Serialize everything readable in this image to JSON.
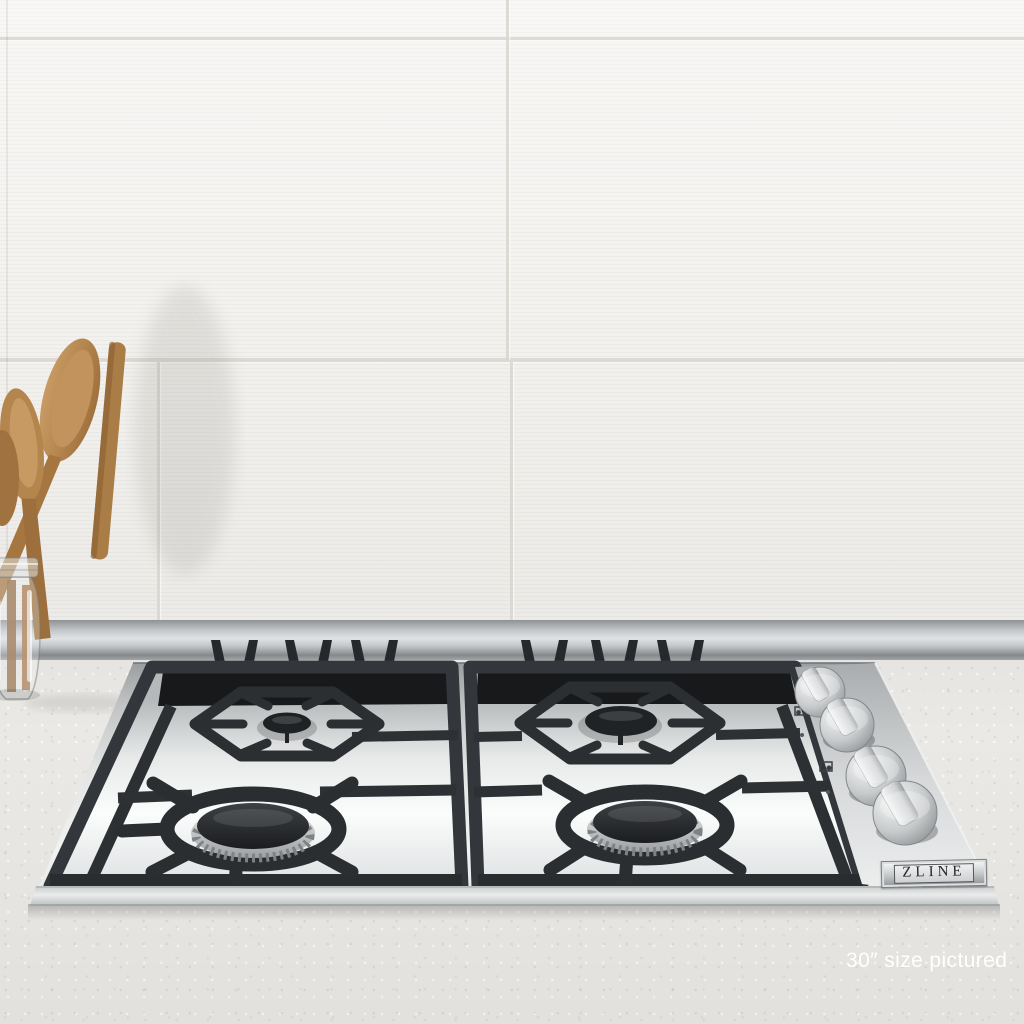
{
  "scene": {
    "description": "Stainless steel drop-in gas cooktop with black cast-iron grates installed in a speckled countertop, white striped tile backsplash behind, and a glass jar of wooden spoons at left."
  },
  "badge": {
    "text": "ZLINE"
  },
  "caption": {
    "text": "30″ size pictured"
  },
  "cooktop": {
    "burner_count": 4,
    "knob_count": 4,
    "burners": [
      {
        "position": "rear-left",
        "size": "small"
      },
      {
        "position": "rear-right",
        "size": "medium"
      },
      {
        "position": "front-left",
        "size": "large"
      },
      {
        "position": "front-right",
        "size": "large"
      }
    ]
  },
  "colors": {
    "wall_tile": "#f4f3f0",
    "grout": "#dad6d0",
    "base_trim": "#b7bbbd",
    "countertop": "#eae9e6",
    "stainless": "#d9dbdc",
    "grate": "#33363a",
    "burner_cap": "#25282b",
    "wood": "#b0814c",
    "caption_text": "#ffffff",
    "badge_text": "#232527"
  }
}
